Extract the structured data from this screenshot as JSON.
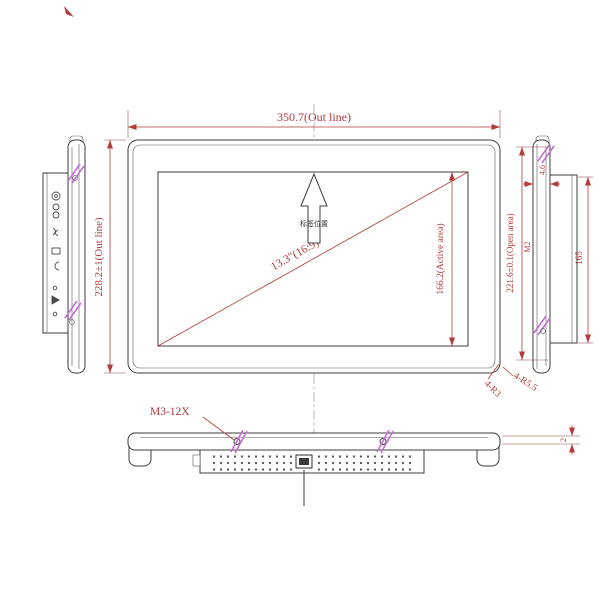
{
  "colors": {
    "line": "#3d3d3d",
    "dimension": "#b23b3b",
    "hatch": "#c26fd1",
    "centerline": "#9a9a9a",
    "background": "#ffffff"
  },
  "front_view": {
    "outline_width_label": "350.7(Out line)",
    "outline_height_label": "228.2±1(Out line)",
    "active_area_label": "166.2(Active area)",
    "diagonal_size_label": "13.3\"(16:9)",
    "arrow_note": "标签位置",
    "corner_radius_label_1": "4-R5.5",
    "corner_radius_label_2": "4-R3"
  },
  "side_view": {
    "open_area_label": "221.6±0.1(Open area)",
    "thread_label": "M2",
    "rear_height_label": "165",
    "front_thickness_label": "4.6",
    "step_label": "2"
  },
  "bottom_view": {
    "screw_spec_label": "M3-12X"
  }
}
